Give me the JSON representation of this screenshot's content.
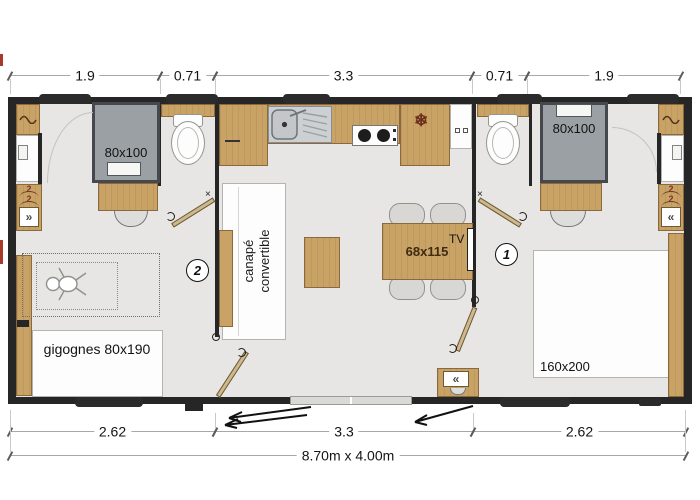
{
  "plan": {
    "overall_size": "8.70m x 4.00m",
    "dimensions_top": [
      "1.9",
      "0.71",
      "3.3",
      "0.71",
      "1.9"
    ],
    "dimensions_bottom": [
      "2.62",
      "3.3",
      "2.62"
    ],
    "rooms": {
      "bedroom1": {
        "badge": "1",
        "bed_label": "160x200",
        "shower_label": "80x100"
      },
      "bedroom2": {
        "badge": "2",
        "bed_label": "gigognes 80x190",
        "shower_label": "80x100"
      },
      "living": {
        "sofa_line1": "canapé",
        "sofa_line2": "convertible",
        "table_label": "68x115",
        "tv_label": "TV"
      }
    },
    "wardrobe_mark": "2",
    "icons": {
      "snowflake": "❄",
      "rack_left": "»",
      "rack_right": "«",
      "hinge_mark": "×"
    },
    "colors": {
      "wall": "#262626",
      "floor": "#e7e6e4",
      "wood": "#c9a265",
      "shower_gray": "#9ba0a4",
      "hanger_red": "#7b382a"
    }
  }
}
